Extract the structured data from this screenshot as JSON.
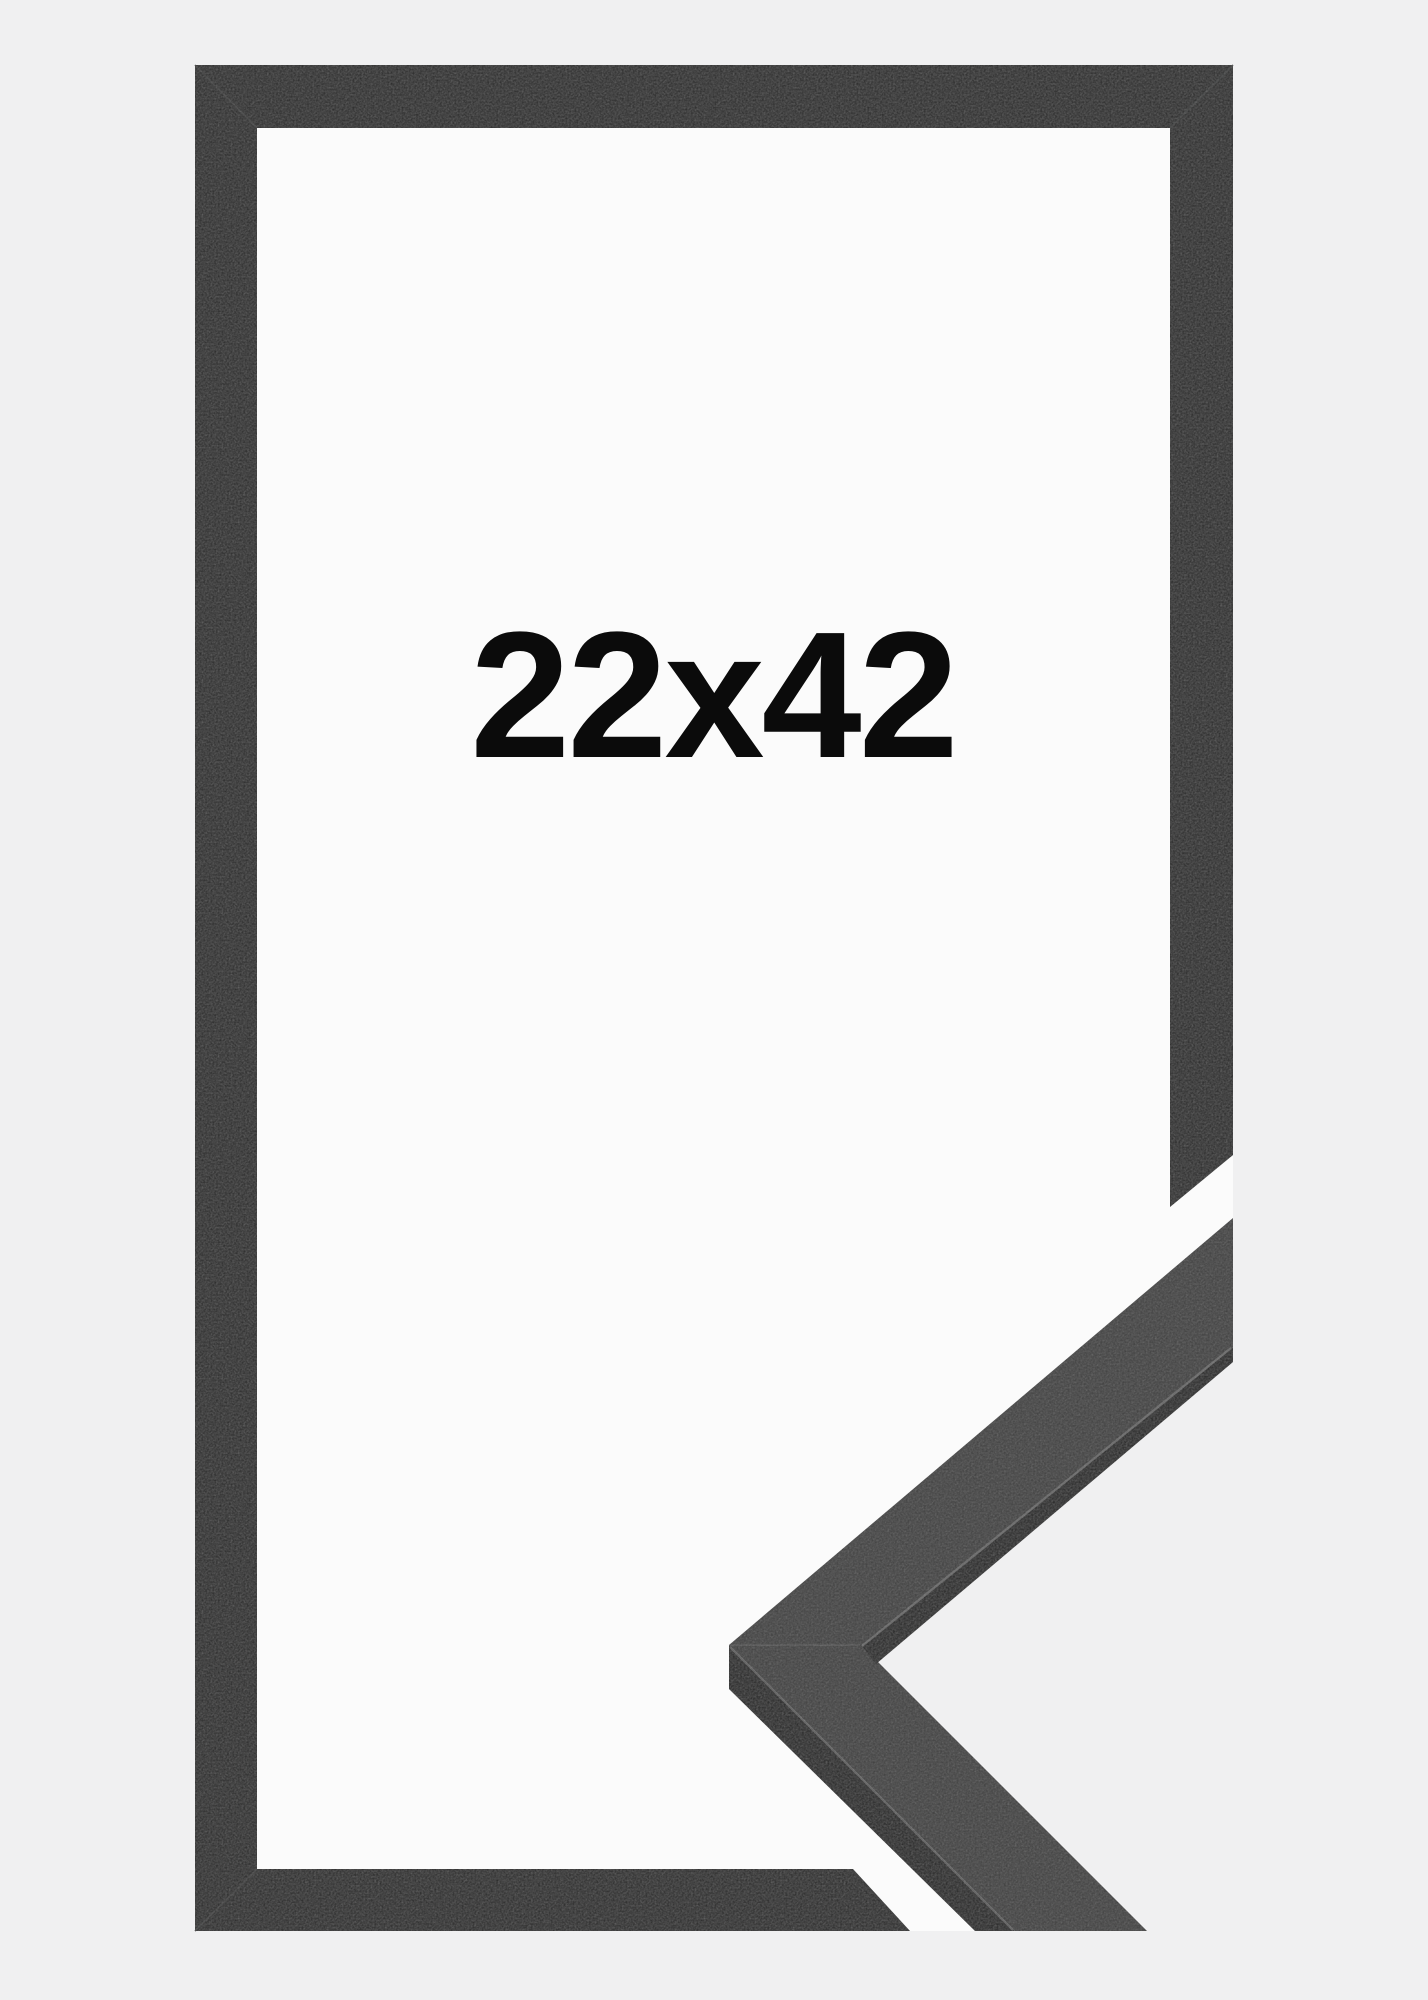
{
  "product": {
    "size_label": "22x42"
  },
  "colors": {
    "background": "#f0f0f1",
    "paper": "#fbfbfb",
    "frame": "#2b2c2c",
    "frame_seam": "#3f4040",
    "profile_face": "#404040",
    "profile_side": "#262626",
    "profile_edge_highlight": "#6e6e6e",
    "profile_seam": "#565656",
    "label_text": "#0b0b0b"
  }
}
